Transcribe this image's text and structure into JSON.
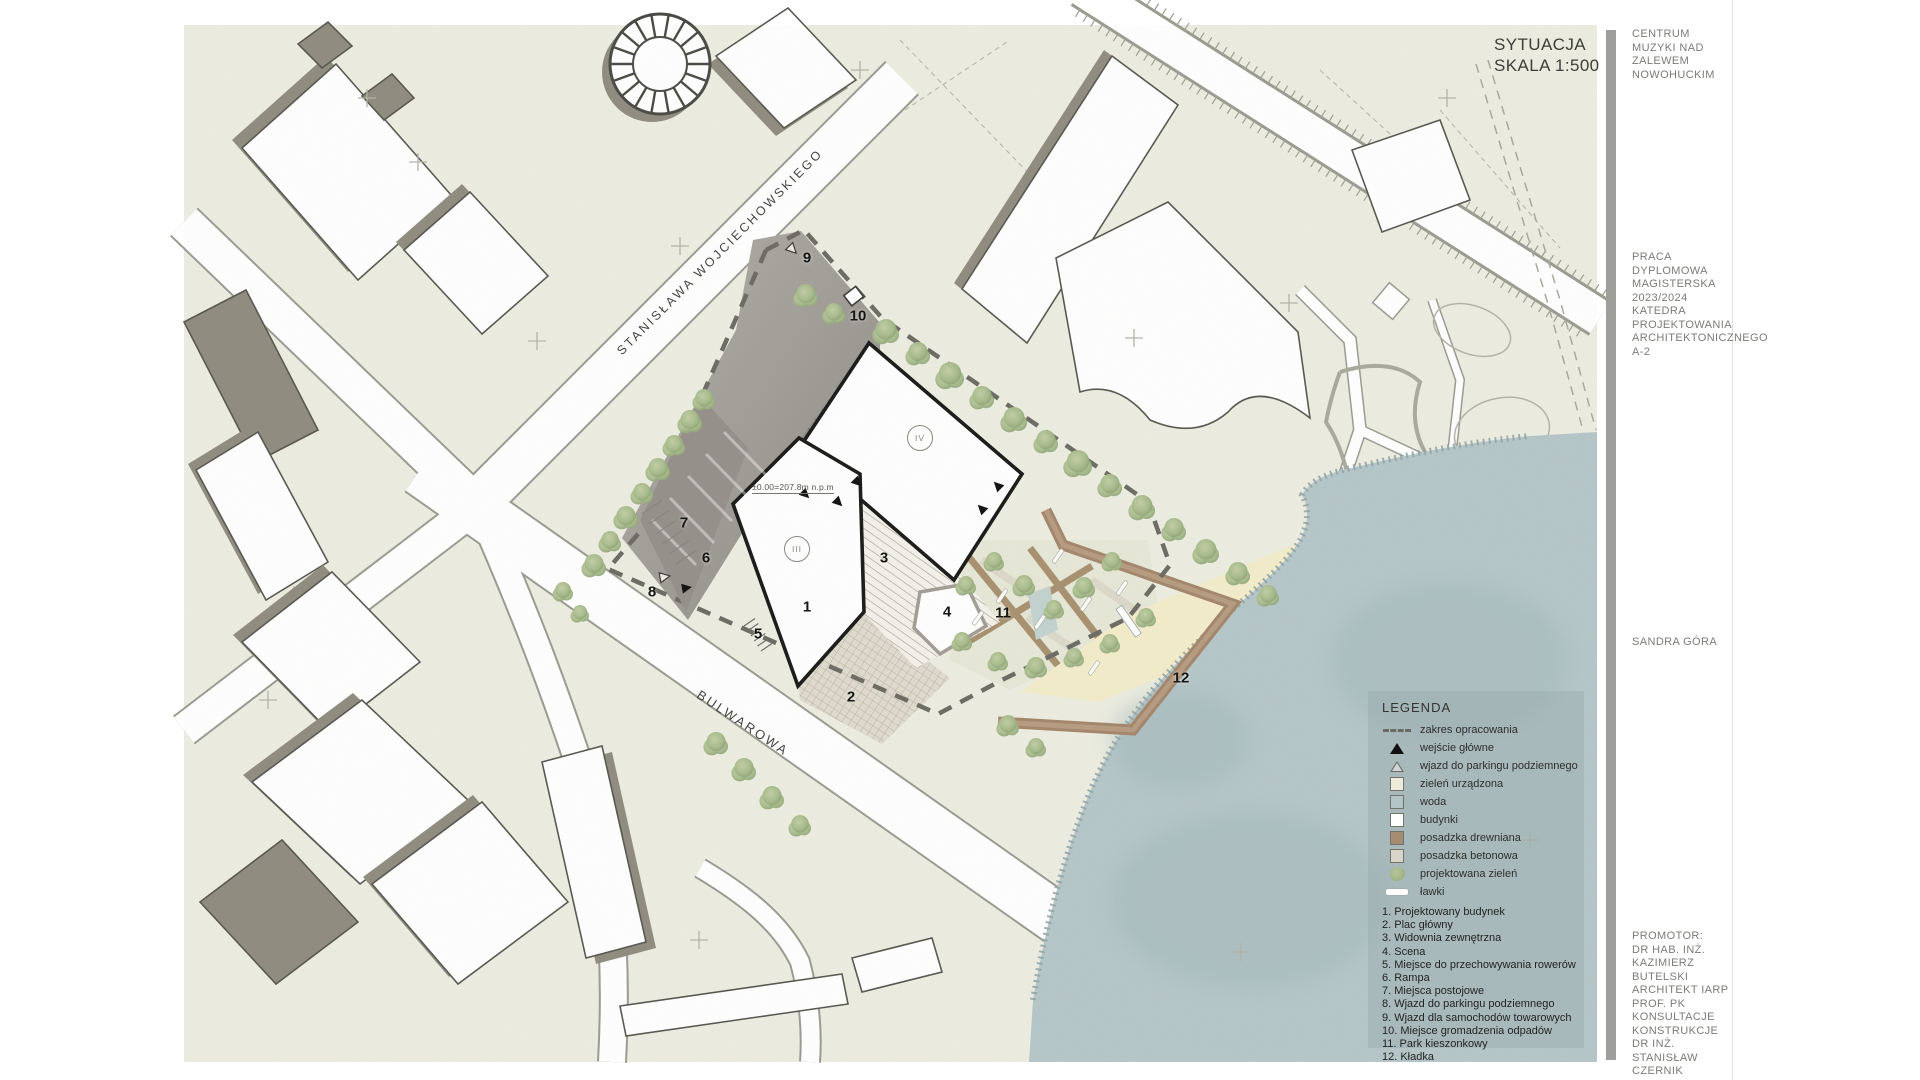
{
  "page": {
    "title_line1": "SYTUACJA",
    "title_line2": "SKALA 1:500"
  },
  "sidebar": {
    "project_lines": [
      "CENTRUM",
      "MUZYKI NAD",
      "ZALEWEM",
      "NOWOHUCKIM"
    ],
    "thesis_lines": [
      "PRACA",
      "DYPLOMOWA",
      "MAGISTERSKA",
      "2023/2024",
      "KATEDRA",
      "PROJEKTOWANIA",
      "ARCHITEKTONICZNEGO",
      "A-2"
    ],
    "author": "SANDRA GÓRA",
    "promoter_lines": [
      "PROMOTOR:",
      "DR HAB. INŻ.",
      "KAZIMIERZ",
      "BUTELSKI",
      "ARCHITEKT IARP",
      "PROF. PK",
      "KONSULTACJE",
      "KONSTRUKCJE",
      "DR INŻ.",
      "STANISŁAW",
      "CZERNIK"
    ]
  },
  "map": {
    "streets": [
      {
        "name": "STANISŁAWA WOJCIECHOWSKIEGO"
      },
      {
        "name": "BULWAROWA"
      }
    ],
    "numbers": [
      "1",
      "2",
      "3",
      "4",
      "5",
      "6",
      "7",
      "8",
      "9",
      "10",
      "11",
      "12"
    ],
    "building_marks": [
      "III",
      "IV"
    ],
    "level_annotation": "±0.00=207.8m  n.p.m"
  },
  "legend": {
    "title": "LEGENDA",
    "symbols": [
      {
        "swatch": "dashes",
        "label": "zakres  opracowania"
      },
      {
        "swatch": "triangle-filled",
        "label": "wejście główne"
      },
      {
        "swatch": "triangle-outline",
        "label": "wjazd do parkingu podziemnego"
      },
      {
        "swatch": "square",
        "color": "#edebdc",
        "label": "zieleń urządzona"
      },
      {
        "swatch": "square",
        "color": "#b4c5c7",
        "label": "woda"
      },
      {
        "swatch": "square",
        "color": "#ffffff",
        "label": "budynki"
      },
      {
        "swatch": "square",
        "color": "#a68c70",
        "label": "posadzka drewniana"
      },
      {
        "swatch": "square",
        "color": "#d9d5c9",
        "label": "posadzka betonowa"
      },
      {
        "swatch": "tree",
        "label": "projektowana zieleń"
      },
      {
        "swatch": "bench",
        "label": "ławki"
      }
    ],
    "items": [
      "1. Projektowany budynek",
      "2. Plac główny",
      "3. Widownia zewnętrzna",
      "4. Scena",
      "5. Miejsce do przechowywania rowerów",
      "6. Rampa",
      "7. Miejsca postojowe",
      "8. Wjazd do parkingu podziemnego",
      "9. Wjazd dla samochodów towarowych",
      "10. Miejsce gromadzenia odpadów",
      "11. Park kieszonkowy",
      "12. Kładka"
    ]
  },
  "colors": {
    "paper": "#ffffff",
    "map_ground": "#ecede0",
    "water": "#b5c6c8",
    "beach": "#f2ecca",
    "wood_deck": "#a3866b",
    "site_paving": "#a5a29b",
    "building_shadow": "#8f8b7f",
    "boundary_dash": "#6b6b64",
    "tree_green": "#a9bd8d"
  }
}
